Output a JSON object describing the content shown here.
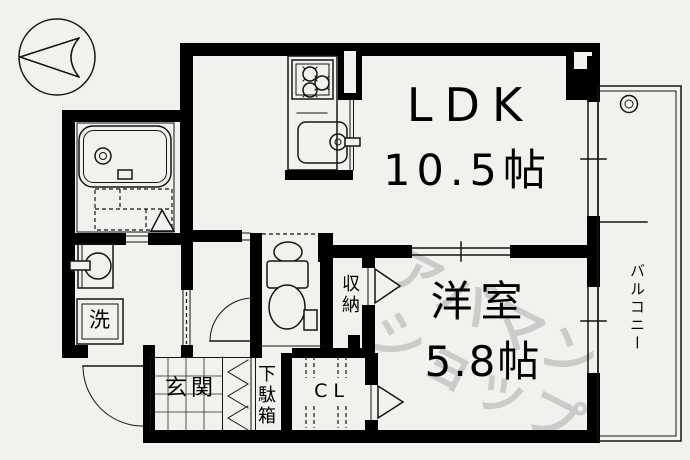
{
  "colors": {
    "background": "#f1f1ed",
    "wall": "#000000",
    "line": "#141414",
    "watermark": "#cbcbcb"
  },
  "labels": {
    "ldk": "LDK",
    "ldk_size": "10.5帖",
    "western_room": "洋室",
    "western_room_size": "5.8帖",
    "balcony": "バルコニー",
    "storage": "収納",
    "closet": "CL",
    "shoe_cabinet": "下駄箱",
    "entrance": "玄関",
    "washing_machine": "洗"
  },
  "watermark": {
    "line1": "アパマン",
    "line2": "ショップ"
  }
}
